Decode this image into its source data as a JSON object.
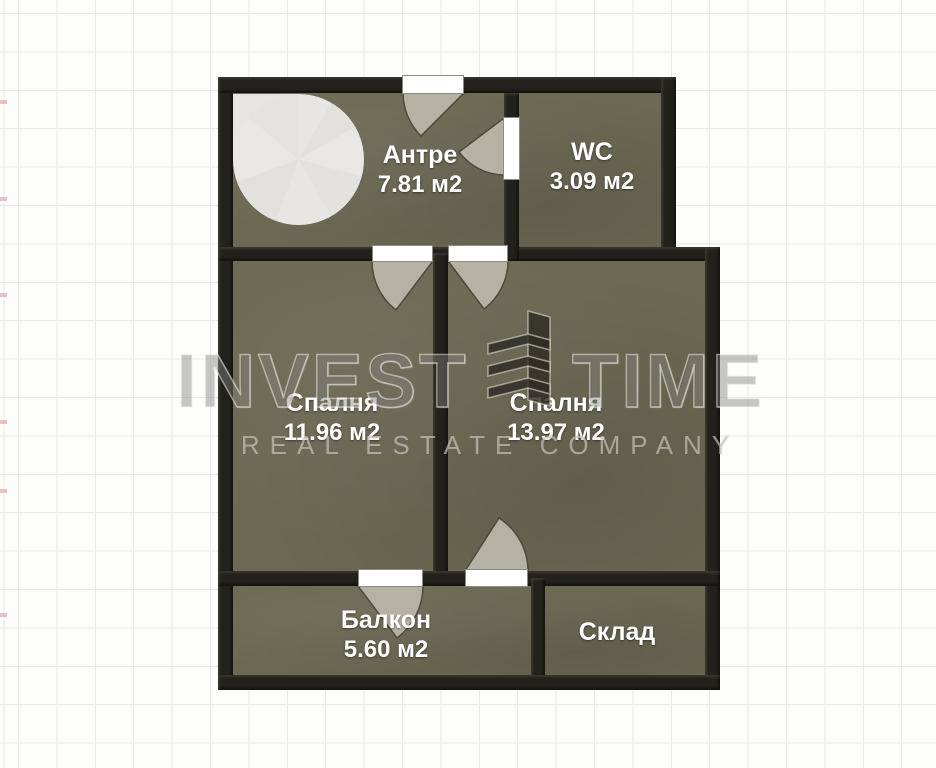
{
  "plan": {
    "rooms": [
      {
        "name": "Антре",
        "area": "7.81 м2"
      },
      {
        "name": "WC",
        "area": "3.09 м2"
      },
      {
        "name": "Спалня",
        "area": "11.96 м2"
      },
      {
        "name": "Спалня",
        "area": "13.97 м2"
      },
      {
        "name": "Балкон",
        "area": "5.60 м2"
      },
      {
        "name": "Склад",
        "area": ""
      }
    ]
  },
  "watermark": {
    "brand_first_word": "INVEST",
    "brand_second_word": "TIME",
    "tagline": "REAL ESTATE COMPANY",
    "logo": "building-icon"
  },
  "colors": {
    "floor": "#6b6853",
    "wall": "#22211c",
    "door_swing": "#b5b2a4",
    "door_opening": "#ffffff",
    "background_grid": "#ebe8e8",
    "label_text": "#ffffff"
  }
}
